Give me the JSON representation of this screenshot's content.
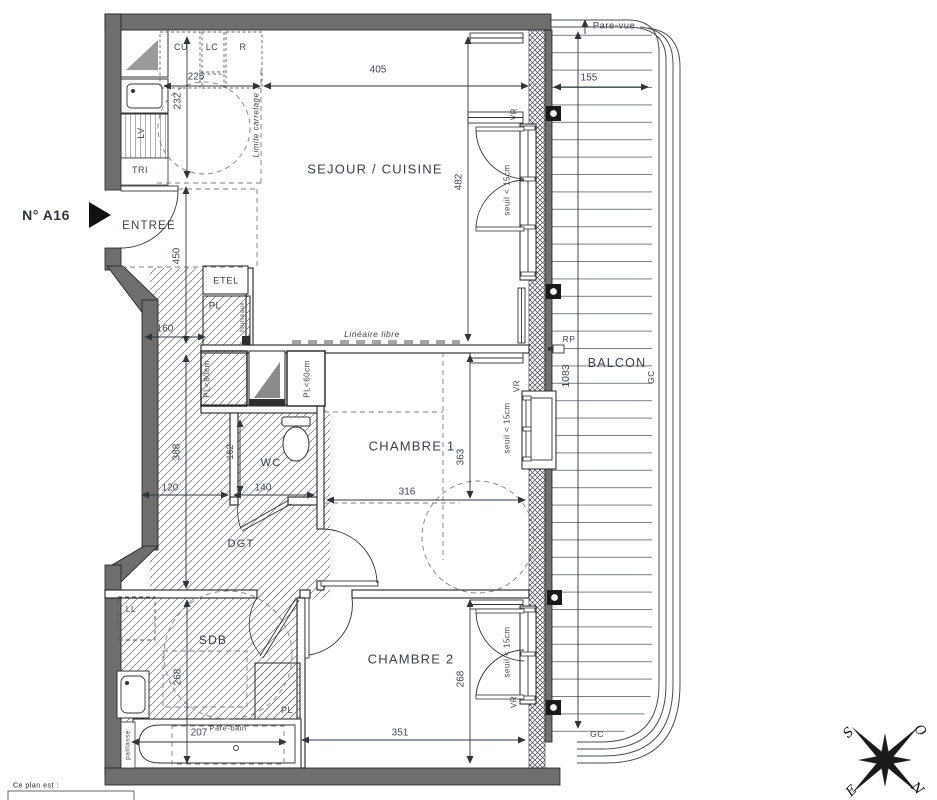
{
  "plan": {
    "unit": "N° A16",
    "rooms": {
      "sejour": "SEJOUR / CUISINE",
      "entree": "ENTREE",
      "chambre1": "CHAMBRE 1",
      "chambre2": "CHAMBRE 2",
      "wc": "WC",
      "sdb": "SDB",
      "dgt": "DGT",
      "balcon": "BALCON",
      "tri": "TRI"
    },
    "kitchen": {
      "cu": "CU",
      "lc": "LC",
      "r": "R",
      "lv": "LV",
      "etel": "ETEL",
      "pl": "PL",
      "fourreaux": "fourreaux",
      "limite_carrelage": "Limite carrelage",
      "lineaire_libre": "Linéaire libre"
    },
    "closets": {
      "pl80": "PL<80cm",
      "pl60": "PL<60cm",
      "pl_ch2": "PL",
      "ll": "LL"
    },
    "bath": {
      "paillasse": "paillasse",
      "pare_bain": "Pare-bain"
    },
    "balcony": {
      "pare_vue": "Pare-vue",
      "gc": "GC",
      "rp": "RP"
    },
    "windows": {
      "vr": "VR",
      "seuil": "seuil < 15cm"
    },
    "dims": {
      "d225": "225",
      "d405": "405",
      "d155": "155",
      "d232": "232",
      "d482": "482",
      "d450": "450",
      "d160": "160",
      "d388": "388",
      "d120": "120",
      "d140": "140",
      "d162": "162",
      "d316": "316",
      "d363": "363",
      "d1083": "1083",
      "d268_ch2": "268",
      "d351": "351",
      "d268_sdb": "268",
      "d207": "207"
    },
    "compass": {
      "n": "N",
      "s": "S",
      "e": "E",
      "o": "O"
    },
    "footer": {
      "legend": "Ce plan est :"
    }
  }
}
